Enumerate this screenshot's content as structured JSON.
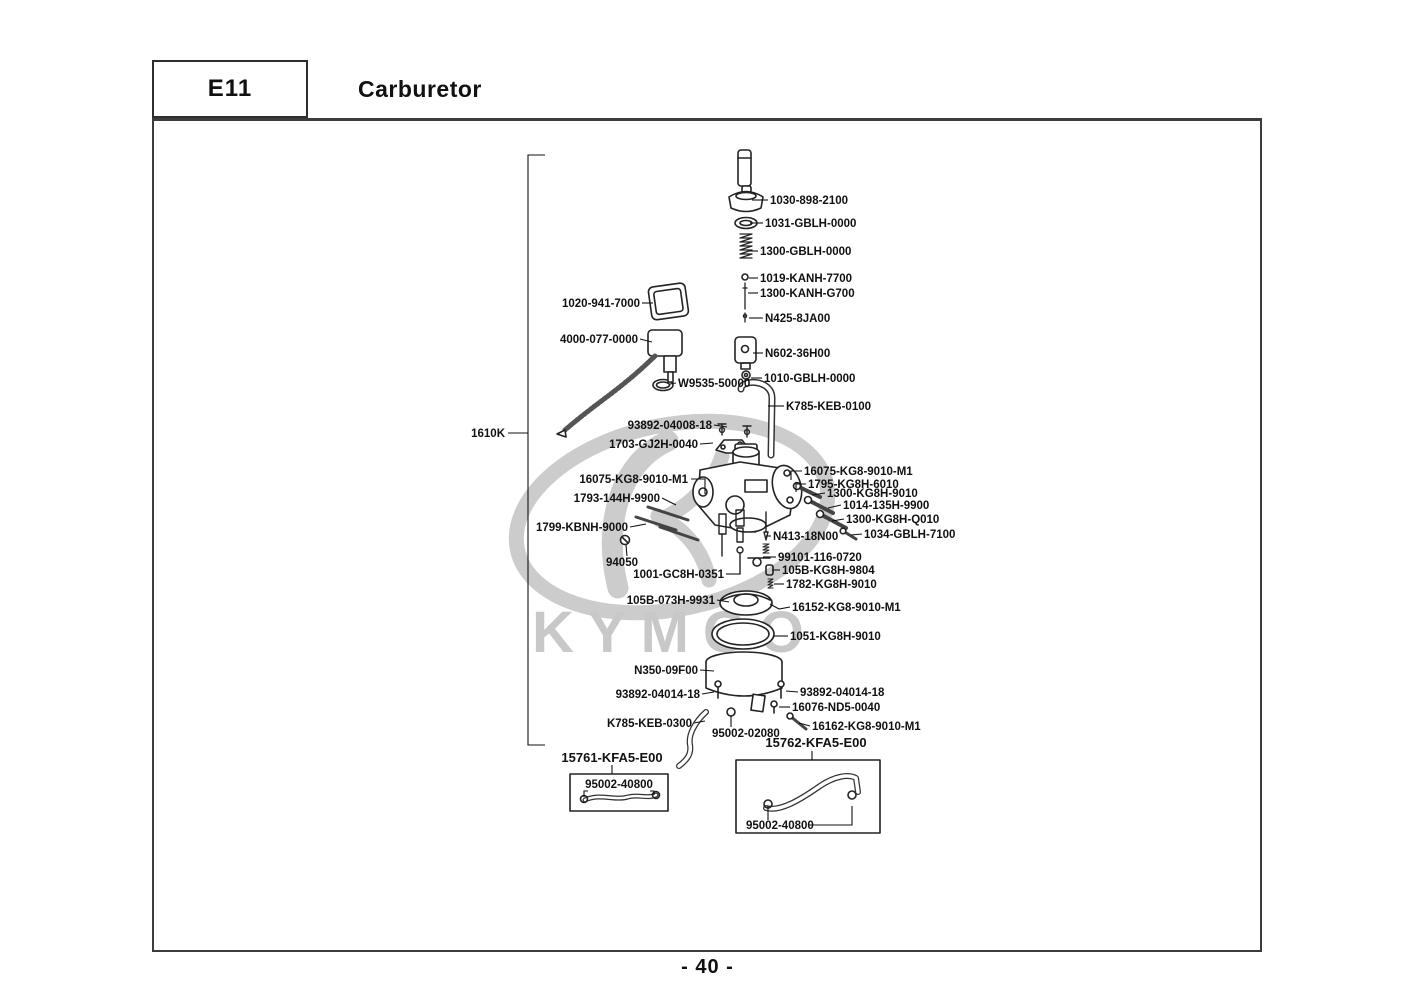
{
  "page": {
    "section_code": "E11",
    "section_title": "Carburetor",
    "page_number": "- 40 -",
    "watermark_text": "KYMCO"
  },
  "colors": {
    "frame_line": "#3c3c3c",
    "label_text": "#111111",
    "watermark_gray": "#c9c9c9"
  },
  "diagram": {
    "assembly_label": "1610K",
    "labels": [
      {
        "text": "1030-898-2100",
        "x": 770,
        "y": 204,
        "anchor": "start",
        "leader": [
          [
            768,
            200
          ],
          [
            752,
            200
          ]
        ]
      },
      {
        "text": "1031-GBLH-0000",
        "x": 765,
        "y": 227,
        "anchor": "start",
        "leader": [
          [
            763,
            223
          ],
          [
            750,
            223
          ]
        ]
      },
      {
        "text": "1300-GBLH-0000",
        "x": 760,
        "y": 255,
        "anchor": "start",
        "leader": [
          [
            758,
            251
          ],
          [
            750,
            251
          ]
        ]
      },
      {
        "text": "1019-KANH-7700",
        "x": 760,
        "y": 282,
        "anchor": "start",
        "leader": [
          [
            758,
            278
          ],
          [
            749,
            278
          ]
        ]
      },
      {
        "text": "1300-KANH-G700",
        "x": 760,
        "y": 297,
        "anchor": "start",
        "leader": [
          [
            758,
            293
          ],
          [
            748,
            293
          ]
        ]
      },
      {
        "text": "N425-8JA00",
        "x": 765,
        "y": 322,
        "anchor": "start",
        "leader": [
          [
            763,
            318
          ],
          [
            749,
            318
          ]
        ]
      },
      {
        "text": "N602-36H00",
        "x": 765,
        "y": 357,
        "anchor": "start",
        "leader": [
          [
            763,
            353
          ],
          [
            753,
            353
          ]
        ]
      },
      {
        "text": "1010-GBLH-0000",
        "x": 764,
        "y": 382,
        "anchor": "start",
        "leader": [
          [
            762,
            378
          ],
          [
            751,
            378
          ]
        ]
      },
      {
        "text": "W9535-50000",
        "x": 678,
        "y": 387,
        "anchor": "start",
        "leader": [
          [
            676,
            383
          ],
          [
            670,
            384
          ]
        ]
      },
      {
        "text": "K785-KEB-0100",
        "x": 786,
        "y": 410,
        "anchor": "start",
        "leader": [
          [
            784,
            406
          ],
          [
            768,
            406
          ]
        ]
      },
      {
        "text": "93892-04008-18",
        "x": 712,
        "y": 429,
        "anchor": "end",
        "leader": [
          [
            714,
            425
          ],
          [
            727,
            427
          ]
        ]
      },
      {
        "text": "1703-GJ2H-0040",
        "x": 698,
        "y": 448,
        "anchor": "end",
        "leader": [
          [
            700,
            444
          ],
          [
            713,
            443
          ]
        ]
      },
      {
        "text": "1020-941-7000",
        "x": 640,
        "y": 307,
        "anchor": "end",
        "leader": [
          [
            642,
            303
          ],
          [
            653,
            303
          ]
        ]
      },
      {
        "text": "4000-077-0000",
        "x": 638,
        "y": 343,
        "anchor": "end",
        "leader": [
          [
            640,
            339
          ],
          [
            652,
            342
          ]
        ]
      },
      {
        "text": "1610K",
        "x": 505,
        "y": 437,
        "anchor": "end",
        "leader": [
          [
            508,
            433
          ],
          [
            528,
            433
          ]
        ]
      },
      {
        "text": "16075-KG8-9010-M1",
        "x": 688,
        "y": 483,
        "anchor": "end",
        "leader": [
          [
            691,
            479
          ],
          [
            705,
            479
          ],
          [
            705,
            494
          ]
        ]
      },
      {
        "text": "1793-144H-9900",
        "x": 660,
        "y": 502,
        "anchor": "end",
        "leader": [
          [
            662,
            498
          ],
          [
            676,
            505
          ]
        ]
      },
      {
        "text": "1799-KBNH-9000",
        "x": 628,
        "y": 531,
        "anchor": "end",
        "leader": [
          [
            630,
            527
          ],
          [
            646,
            524
          ]
        ]
      },
      {
        "text": "94050",
        "x": 638,
        "y": 566,
        "anchor": "end",
        "leader": [
          [
            627,
            556
          ],
          [
            626,
            545
          ]
        ]
      },
      {
        "text": "1001-GC8H-0351",
        "x": 724,
        "y": 578,
        "anchor": "end",
        "leader": [
          [
            726,
            574
          ],
          [
            740,
            574
          ]
        ]
      },
      {
        "text": "16075-KG8-9010-M1",
        "x": 804,
        "y": 475,
        "anchor": "start",
        "leader": [
          [
            802,
            471
          ],
          [
            791,
            471
          ],
          [
            791,
            480
          ]
        ]
      },
      {
        "text": "1795-KG8H-6010",
        "x": 808,
        "y": 488,
        "anchor": "start",
        "leader": [
          [
            806,
            484
          ],
          [
            796,
            484
          ],
          [
            796,
            492
          ]
        ]
      },
      {
        "text": "1300-KG8H-9010",
        "x": 827,
        "y": 497,
        "anchor": "start",
        "leader": [
          [
            825,
            493
          ],
          [
            812,
            495
          ]
        ]
      },
      {
        "text": "1014-135H-9900",
        "x": 843,
        "y": 509,
        "anchor": "start",
        "leader": [
          [
            841,
            505
          ],
          [
            828,
            508
          ]
        ]
      },
      {
        "text": "1300-KG8H-Q010",
        "x": 846,
        "y": 523,
        "anchor": "start",
        "leader": [
          [
            844,
            519
          ],
          [
            832,
            521
          ]
        ]
      },
      {
        "text": "1034-GBLH-7100",
        "x": 864,
        "y": 538,
        "anchor": "start",
        "leader": [
          [
            862,
            534
          ],
          [
            851,
            535
          ]
        ]
      },
      {
        "text": "N413-18N00",
        "x": 773,
        "y": 540,
        "anchor": "start",
        "leader": [
          [
            771,
            536
          ],
          [
            766,
            536
          ]
        ]
      },
      {
        "text": "99101-116-0720",
        "x": 778,
        "y": 561,
        "anchor": "start",
        "leader": [
          [
            776,
            557
          ],
          [
            763,
            557
          ]
        ]
      },
      {
        "text": "105B-KG8H-9804",
        "x": 782,
        "y": 574,
        "anchor": "start",
        "leader": [
          [
            780,
            570
          ],
          [
            772,
            570
          ]
        ]
      },
      {
        "text": "1782-KG8H-9010",
        "x": 786,
        "y": 588,
        "anchor": "start",
        "leader": [
          [
            784,
            584
          ],
          [
            774,
            584
          ]
        ]
      },
      {
        "text": "105B-073H-9931",
        "x": 715,
        "y": 604,
        "anchor": "end",
        "leader": [
          [
            717,
            600
          ],
          [
            729,
            602
          ]
        ]
      },
      {
        "text": "16152-KG8-9010-M1",
        "x": 792,
        "y": 611,
        "anchor": "start",
        "leader": [
          [
            790,
            607
          ],
          [
            779,
            609
          ],
          [
            770,
            604
          ]
        ]
      },
      {
        "text": "1051-KG8H-9010",
        "x": 790,
        "y": 640,
        "anchor": "start",
        "leader": [
          [
            788,
            636
          ],
          [
            773,
            636
          ]
        ]
      },
      {
        "text": "N350-09F00",
        "x": 698,
        "y": 674,
        "anchor": "end",
        "leader": [
          [
            700,
            670
          ],
          [
            714,
            671
          ]
        ]
      },
      {
        "text": "93892-04014-18",
        "x": 700,
        "y": 698,
        "anchor": "end",
        "leader": [
          [
            702,
            694
          ],
          [
            714,
            692
          ]
        ]
      },
      {
        "text": "93892-04014-18",
        "x": 800,
        "y": 696,
        "anchor": "start",
        "leader": [
          [
            798,
            692
          ],
          [
            786,
            691
          ]
        ]
      },
      {
        "text": "16076-ND5-0040",
        "x": 792,
        "y": 711,
        "anchor": "start",
        "leader": [
          [
            790,
            707
          ],
          [
            779,
            707
          ]
        ]
      },
      {
        "text": "K785-KEB-0300",
        "x": 692,
        "y": 727,
        "anchor": "end",
        "leader": [
          [
            694,
            723
          ],
          [
            705,
            721
          ]
        ]
      },
      {
        "text": "95002-02080",
        "x": 712,
        "y": 737,
        "anchor": "start",
        "leader": [
          [
            731,
            727
          ],
          [
            731,
            716
          ]
        ]
      },
      {
        "text": "16162-KG8-9010-M1",
        "x": 812,
        "y": 730,
        "anchor": "start",
        "leader": [
          [
            810,
            726
          ],
          [
            799,
            723
          ]
        ]
      },
      {
        "text": "15762-KFA5-E00",
        "x": 816,
        "y": 747,
        "anchor": "middle",
        "size": 13,
        "leader": [
          [
            812,
            751
          ],
          [
            812,
            760
          ]
        ]
      },
      {
        "text": "15761-KFA5-E00",
        "x": 612,
        "y": 762,
        "anchor": "middle",
        "size": 13,
        "leader": [
          [
            612,
            765
          ],
          [
            612,
            774
          ]
        ]
      },
      {
        "text": "95002-40800",
        "x": 619,
        "y": 788,
        "anchor": "middle",
        "leader": [
          [
            588,
            791
          ],
          [
            584,
            791
          ],
          [
            584,
            797
          ]
        ],
        "leader2": [
          [
            650,
            791
          ],
          [
            654,
            791
          ],
          [
            654,
            795
          ]
        ]
      },
      {
        "text": "95002-40800",
        "x": 746,
        "y": 829,
        "anchor": "start",
        "leader": [
          [
            809,
            825
          ],
          [
            852,
            825
          ],
          [
            852,
            806
          ]
        ],
        "leader2": [
          [
            768,
            820
          ],
          [
            768,
            806
          ]
        ]
      }
    ]
  }
}
